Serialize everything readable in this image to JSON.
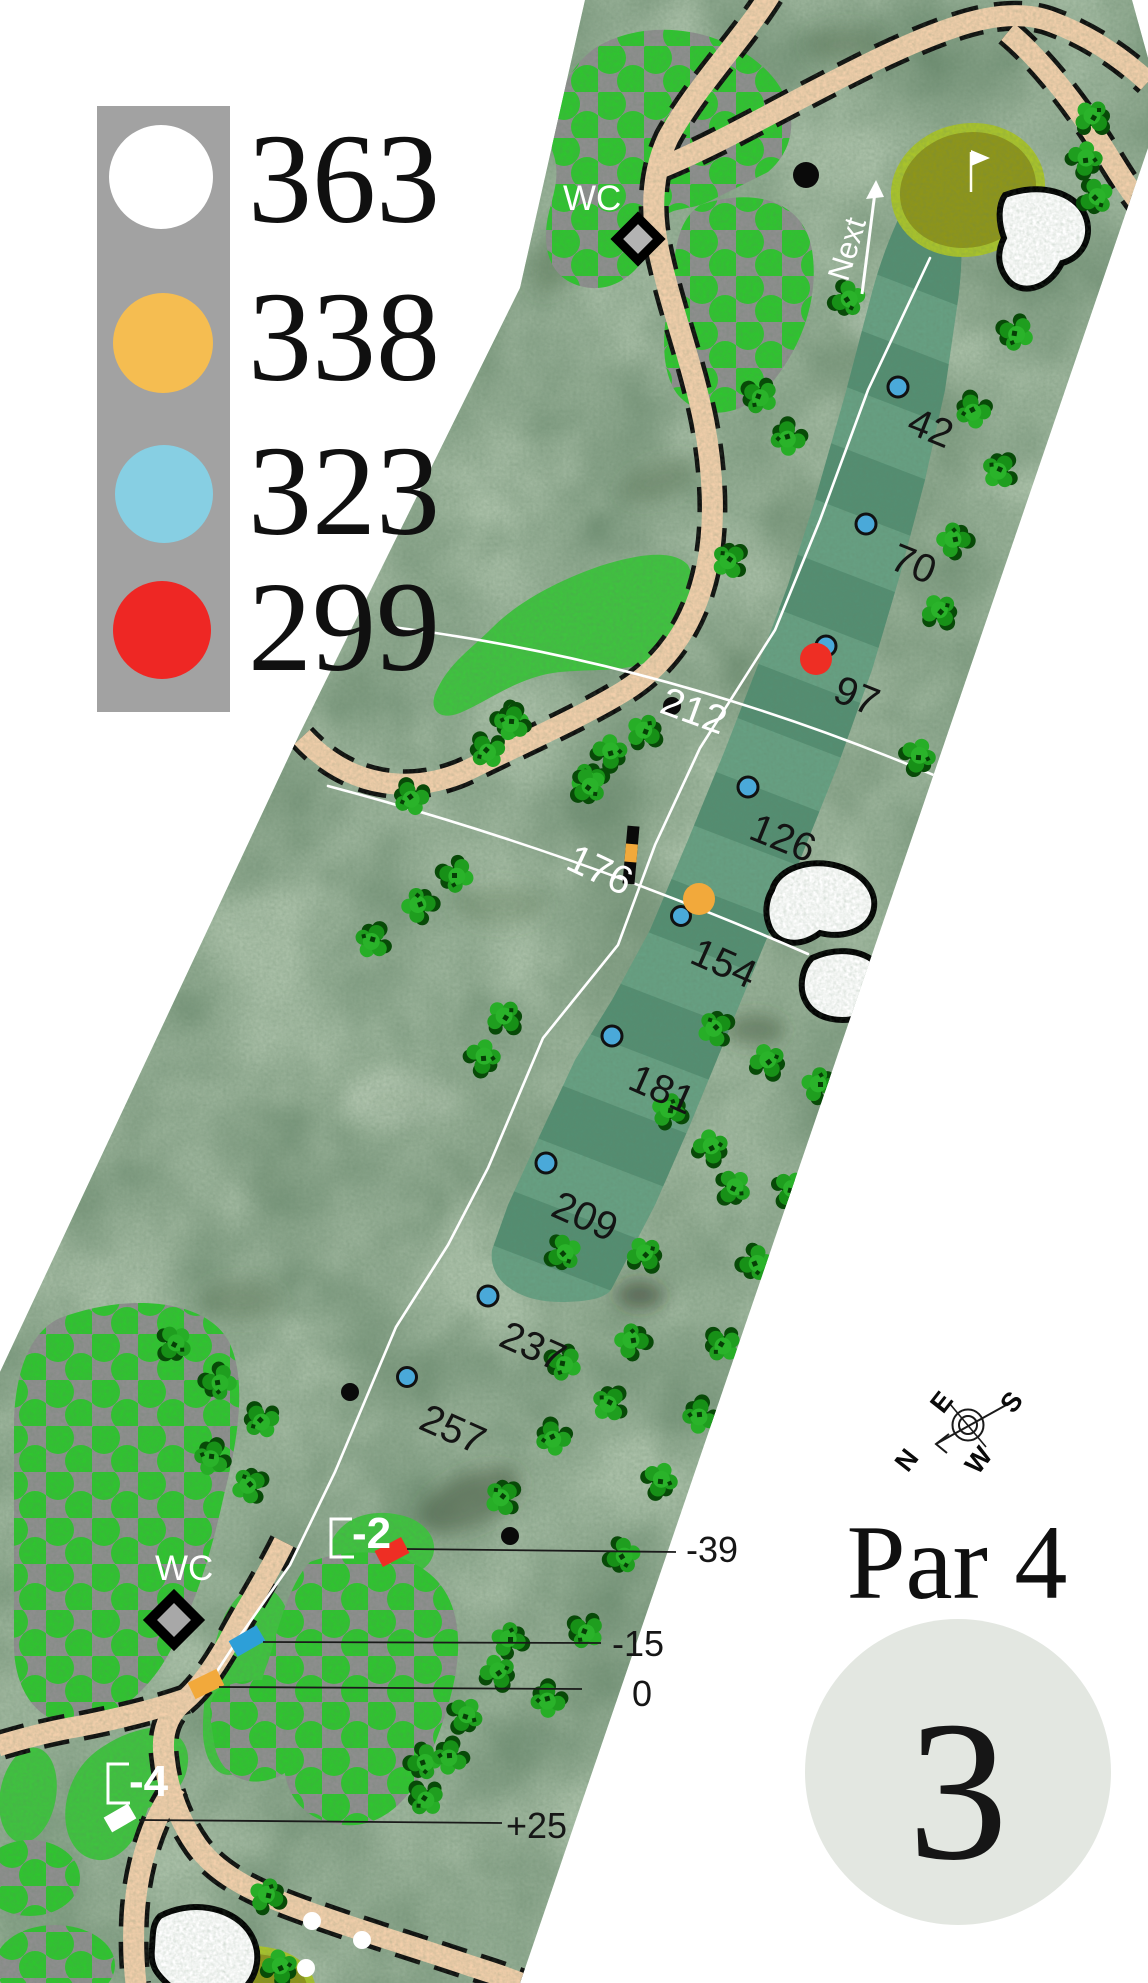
{
  "hole": {
    "number": "3",
    "par_label": "Par 4"
  },
  "tee_legend": [
    {
      "name": "white-tee",
      "color": "#ffffff",
      "distance": "363"
    },
    {
      "name": "yellow-tee",
      "color": "#f5bd51",
      "distance": "338"
    },
    {
      "name": "blue-tee",
      "color": "#87cfe3",
      "distance": "323"
    },
    {
      "name": "red-tee",
      "color": "#ee2724",
      "distance": "299"
    }
  ],
  "distance_markers": [
    {
      "value": "42"
    },
    {
      "value": "70"
    },
    {
      "value": "97"
    },
    {
      "value": "126"
    },
    {
      "value": "154"
    },
    {
      "value": "181"
    },
    {
      "value": "209"
    },
    {
      "value": "237"
    },
    {
      "value": "257"
    }
  ],
  "crossline_markers": [
    {
      "value": "212"
    },
    {
      "value": "176"
    }
  ],
  "elevation_callouts": [
    {
      "value": "-39"
    },
    {
      "value": "-15"
    },
    {
      "value": "0"
    },
    {
      "value": "+25"
    }
  ],
  "tee_elevation_signs": [
    {
      "value": "-2"
    },
    {
      "value": "-4"
    }
  ],
  "facilities": {
    "wc_top": "WC",
    "wc_bottom": "WC"
  },
  "navigation": {
    "next_label": "Next"
  },
  "compass": {
    "north": "N",
    "east": "E",
    "south": "S",
    "west": "W"
  },
  "colors": {
    "rough": "#a9bfa7",
    "fairway": "#67a083",
    "fairway_stripe": "#2e6a4e",
    "tree_area_bg": "#8f8f8f",
    "tree_area_dot": "#2fc52f",
    "bright_green": "#3fc33f",
    "putting_green": "#8e9519",
    "green_ring": "#a9c32b",
    "path": "#f2cfab",
    "legend_bg": "#a2a2a2",
    "hole_badge_bg": "#e3e7e1",
    "map_blue": "#2d9fd8",
    "map_yellow": "#f2a93b",
    "map_red": "#ee2e24",
    "map_white": "#ffffff",
    "marker_dot": "#4aa9d9"
  }
}
